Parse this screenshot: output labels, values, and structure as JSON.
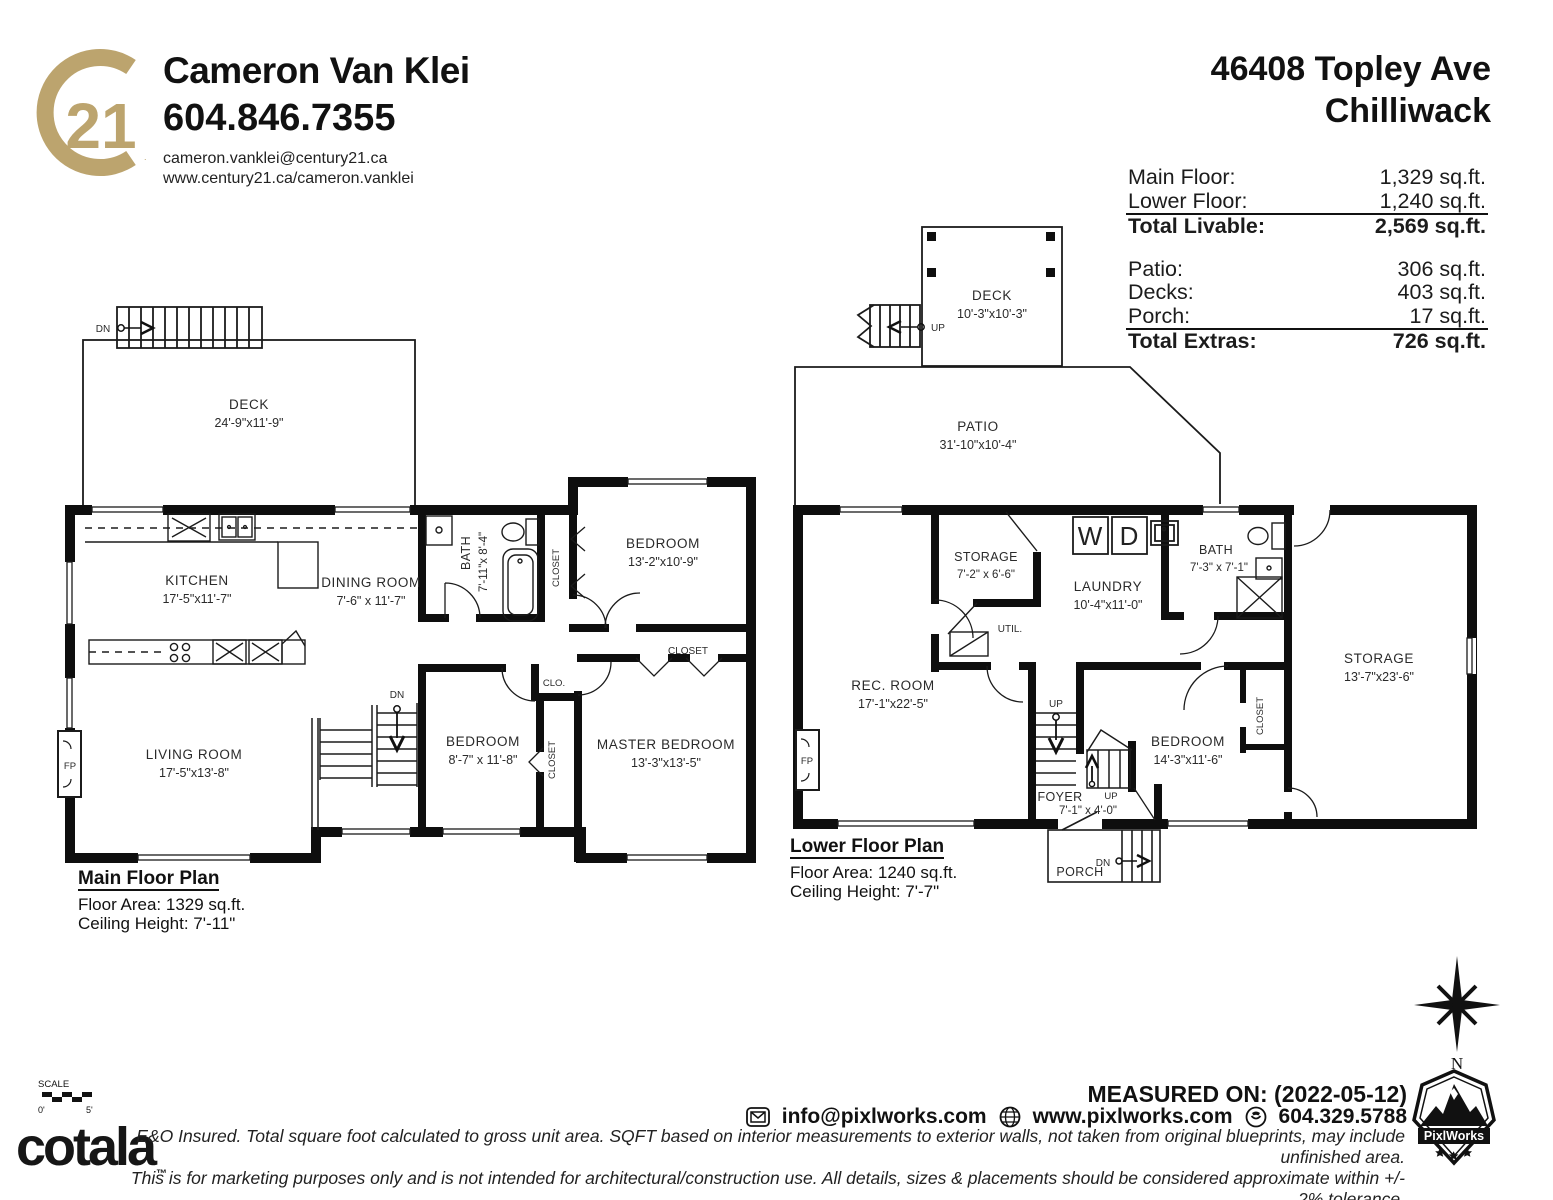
{
  "brand": {
    "logo_number": "21",
    "logo_color": "#BCA46E",
    "agent_name": "Cameron Van Klei",
    "phone": "604.846.7355",
    "email": "cameron.vanklei@century21.ca",
    "website": "www.century21.ca/cameron.vanklei"
  },
  "property": {
    "address_line1": "46408 Topley Ave",
    "address_line2": "Chilliwack"
  },
  "area_summary": {
    "livable": [
      {
        "label": "Main Floor:",
        "value": "1,329 sq.ft."
      },
      {
        "label": "Lower Floor:",
        "value": "1,240 sq.ft."
      }
    ],
    "livable_total": {
      "label": "Total Livable:",
      "value": "2,569 sq.ft."
    },
    "extras": [
      {
        "label": "Patio:",
        "value": "306 sq.ft."
      },
      {
        "label": "Decks:",
        "value": "403 sq.ft."
      },
      {
        "label": "Porch:",
        "value": "17 sq.ft."
      }
    ],
    "extras_total": {
      "label": "Total Extras:",
      "value": "726 sq.ft."
    }
  },
  "main_floor": {
    "caption_title": "Main Floor Plan",
    "caption_area": "Floor Area: 1329 sq.ft.",
    "caption_ceiling": "Ceiling Height: 7'-11\"",
    "deck": {
      "name": "DECK",
      "dims": "24'-9\"x11'-9\""
    },
    "kitchen": {
      "name": "KITCHEN",
      "dims": "17'-5\"x11'-7\""
    },
    "dining": {
      "name": "DINING ROOM",
      "dims": "7'-6\" x 11'-7\""
    },
    "bath": {
      "name": "BATH",
      "dims": "7'-11\"x 8'-4\""
    },
    "bedroom1": {
      "name": "BEDROOM",
      "dims": "13'-2\"x10'-9\""
    },
    "living": {
      "name": "LIVING ROOM",
      "dims": "17'-5\"x13'-8\""
    },
    "bedroom2": {
      "name": "BEDROOM",
      "dims": "8'-7\" x 11'-8\""
    },
    "master": {
      "name": "MASTER BEDROOM",
      "dims": "13'-3\"x13'-5\""
    },
    "labels": {
      "closet": "CLOSET",
      "clo": "CLO.",
      "dn": "DN",
      "fp": "FP"
    }
  },
  "lower_floor": {
    "caption_title": "Lower Floor Plan",
    "caption_area": "Floor Area: 1240 sq.ft.",
    "caption_ceiling": "Ceiling Height: 7'-7\"",
    "deck": {
      "name": "DECK",
      "dims": "10'-3\"x10'-3\""
    },
    "patio": {
      "name": "PATIO",
      "dims": "31'-10\"x10'-4\""
    },
    "storage1": {
      "name": "STORAGE",
      "dims": "7'-2\" x 6'-6\""
    },
    "laundry": {
      "name": "LAUNDRY",
      "dims": "10'-4\"x11'-0\""
    },
    "bath": {
      "name": "BATH",
      "dims": "7'-3\" x 7'-1\""
    },
    "storage2": {
      "name": "STORAGE",
      "dims": "13'-7\"x23'-6\""
    },
    "rec_room": {
      "name": "REC. ROOM",
      "dims": "17'-1\"x22'-5\""
    },
    "bedroom": {
      "name": "BEDROOM",
      "dims": "14'-3\"x11'-6\""
    },
    "foyer": {
      "name": "FOYER",
      "dims": "7'-1\" x 4'-0\""
    },
    "util": "UTIL.",
    "porch": "PORCH",
    "washer": "W",
    "dryer": "D",
    "labels": {
      "closet": "CLOSET",
      "up": "UP",
      "dn": "DN",
      "fp": "FP"
    }
  },
  "scale_bar": {
    "title": "SCALE",
    "start": "0'",
    "end": "5'"
  },
  "compass": {
    "north": "N"
  },
  "footer": {
    "cotala": "cotala",
    "cotala_tm": "™",
    "measured_on": "MEASURED ON: (2022-05-12)",
    "contact_email": "info@pixlworks.com",
    "contact_web": "www.pixlworks.com",
    "contact_phone": "604.329.5788",
    "pixlworks": "PixlWorks",
    "disclaimer_line1": "E&O Insured.  Total square foot calculated to gross unit area. SQFT based on interior measurements to exterior walls, not taken from original blueprints, may include unfinished area.",
    "disclaimer_line2": "This is for marketing purposes only and is not intended for architectural/construction use.  All details, sizes & placements should be considered approximate within +/- 2%  tolerance."
  }
}
